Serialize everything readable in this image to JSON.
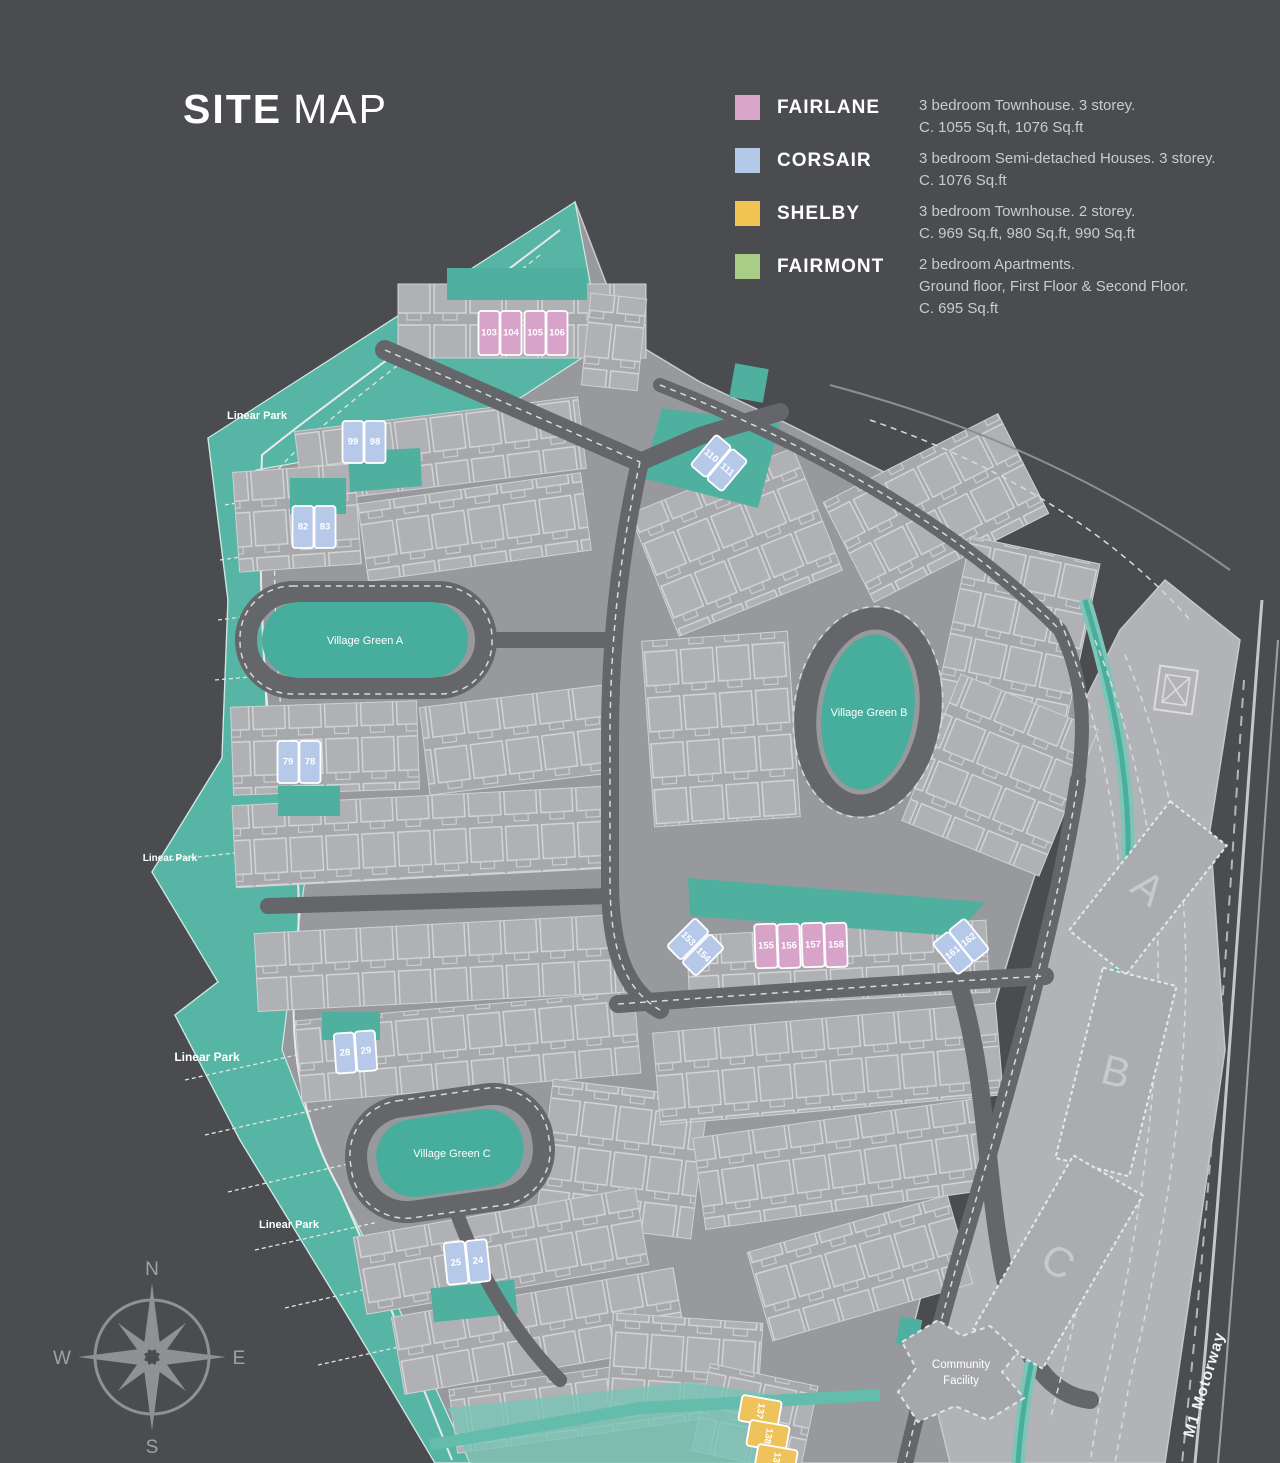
{
  "title": {
    "bold": "SITE",
    "light": "MAP"
  },
  "legend": [
    {
      "name": "FAIRLANE",
      "color": "#d7a6c8",
      "l1": "3 bedroom Townhouse. 3 storey.",
      "l2": "C. 1055 Sq.ft, 1076 Sq.ft",
      "l3": ""
    },
    {
      "name": "CORSAIR",
      "color": "#b4c8e8",
      "l1": "3 bedroom Semi-detached Houses. 3 storey.",
      "l2": "C. 1076 Sq.ft",
      "l3": ""
    },
    {
      "name": "SHELBY",
      "color": "#f2c453",
      "l1": "3 bedroom Townhouse. 2 storey.",
      "l2": "C. 969 Sq.ft, 980 Sq.ft, 990 Sq.ft",
      "l3": ""
    },
    {
      "name": "FAIRMONT",
      "color": "#a9cd87",
      "l1": "2 bedroom Apartments.",
      "l2": "Ground floor, First Floor & Second Floor.",
      "l3": "C. 695 Sq.ft"
    }
  ],
  "map": {
    "village_greens": [
      {
        "label": "Village Green A"
      },
      {
        "label": "Village Green B"
      },
      {
        "label": "Village Green C"
      }
    ],
    "park_labels": [
      {
        "text": "Linear Park"
      },
      {
        "text": "Linear Park"
      },
      {
        "text": "Linear Park"
      },
      {
        "text": "Linear Park"
      }
    ],
    "community_facility": {
      "line1": "Community",
      "line2": "Facility"
    },
    "motorway_label": "M1 Motorway",
    "blocks": [
      {
        "letter": "A"
      },
      {
        "letter": "B"
      },
      {
        "letter": "C"
      }
    ],
    "compass": {
      "n": "N",
      "e": "E",
      "s": "S",
      "w": "W"
    },
    "unit_types": {
      "fairlane": "#d7a3c8",
      "corsair": "#b6c9e9",
      "shelby": "#efc35c"
    },
    "units": [
      {
        "n": "103",
        "t": "fairlane",
        "x": 489,
        "y": 333,
        "w": 21,
        "h": 44,
        "r": 0
      },
      {
        "n": "104",
        "t": "fairlane",
        "x": 511,
        "y": 333,
        "w": 21,
        "h": 44,
        "r": 0
      },
      {
        "n": "105",
        "t": "fairlane",
        "x": 535,
        "y": 333,
        "w": 21,
        "h": 44,
        "r": 0
      },
      {
        "n": "106",
        "t": "fairlane",
        "x": 557,
        "y": 333,
        "w": 21,
        "h": 44,
        "r": 0
      },
      {
        "n": "99",
        "t": "corsair",
        "x": 353,
        "y": 442,
        "w": 21,
        "h": 42,
        "r": 0
      },
      {
        "n": "98",
        "t": "corsair",
        "x": 375,
        "y": 442,
        "w": 21,
        "h": 42,
        "r": 0
      },
      {
        "n": "82",
        "t": "corsair",
        "x": 303,
        "y": 527,
        "w": 21,
        "h": 42,
        "r": 0
      },
      {
        "n": "83",
        "t": "corsair",
        "x": 325,
        "y": 527,
        "w": 21,
        "h": 42,
        "r": 0
      },
      {
        "n": "79",
        "t": "corsair",
        "x": 288,
        "y": 762,
        "w": 21,
        "h": 42,
        "r": 0
      },
      {
        "n": "78",
        "t": "corsair",
        "x": 310,
        "y": 762,
        "w": 21,
        "h": 42,
        "r": 0
      },
      {
        "n": "110",
        "t": "corsair",
        "x": 711,
        "y": 456,
        "w": 20,
        "h": 40,
        "r": 40
      },
      {
        "n": "111",
        "t": "corsair",
        "x": 727,
        "y": 470,
        "w": 20,
        "h": 40,
        "r": 40
      },
      {
        "n": "28",
        "t": "corsair",
        "x": 345,
        "y": 1053,
        "w": 20,
        "h": 40,
        "r": -4
      },
      {
        "n": "29",
        "t": "corsair",
        "x": 366,
        "y": 1051,
        "w": 20,
        "h": 40,
        "r": -4
      },
      {
        "n": "25",
        "t": "corsair",
        "x": 456,
        "y": 1263,
        "w": 21,
        "h": 42,
        "r": -6
      },
      {
        "n": "24",
        "t": "corsair",
        "x": 478,
        "y": 1261,
        "w": 21,
        "h": 42,
        "r": -6
      },
      {
        "n": "153",
        "t": "corsair",
        "x": 688,
        "y": 939,
        "w": 20,
        "h": 40,
        "r": 45
      },
      {
        "n": "154",
        "t": "corsair",
        "x": 703,
        "y": 955,
        "w": 20,
        "h": 40,
        "r": 45
      },
      {
        "n": "155",
        "t": "fairlane",
        "x": 766,
        "y": 946,
        "w": 22,
        "h": 44,
        "r": -2
      },
      {
        "n": "156",
        "t": "fairlane",
        "x": 789,
        "y": 946,
        "w": 22,
        "h": 44,
        "r": -2
      },
      {
        "n": "157",
        "t": "fairlane",
        "x": 813,
        "y": 945,
        "w": 22,
        "h": 44,
        "r": -2
      },
      {
        "n": "158",
        "t": "fairlane",
        "x": 836,
        "y": 945,
        "w": 22,
        "h": 44,
        "r": -2
      },
      {
        "n": "161",
        "t": "corsair",
        "x": 953,
        "y": 953,
        "w": 20,
        "h": 40,
        "r": -39
      },
      {
        "n": "162",
        "t": "corsair",
        "x": 969,
        "y": 940,
        "w": 20,
        "h": 40,
        "r": -39
      },
      {
        "n": "137",
        "t": "shelby",
        "x": 760,
        "y": 1411,
        "w": 40,
        "h": 26,
        "r": 10,
        "tr": 90
      },
      {
        "n": "138",
        "t": "shelby",
        "x": 768,
        "y": 1436,
        "w": 40,
        "h": 26,
        "r": 10,
        "tr": 90
      },
      {
        "n": "139",
        "t": "shelby",
        "x": 776,
        "y": 1460,
        "w": 40,
        "h": 26,
        "r": 10,
        "tr": 90
      }
    ]
  },
  "colors": {
    "background": "#4a4c50",
    "ground": "#97999c",
    "verge": "#b1b3b6",
    "road": "#64666a",
    "green": "#47ad9c",
    "park": "#56b5a4"
  }
}
